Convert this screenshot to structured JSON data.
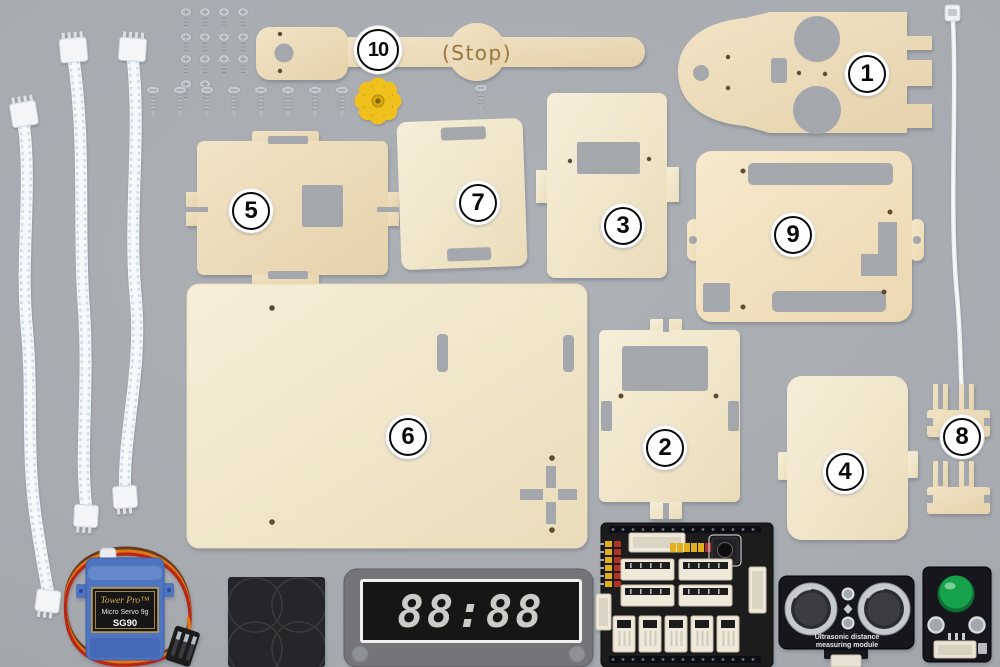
{
  "scene": {
    "width": 1000,
    "height": 667,
    "background": "#a7abb0",
    "description": "robot kit parts flat lay"
  },
  "badges": [
    {
      "num": "1",
      "x": 867,
      "y": 74
    },
    {
      "num": "2",
      "x": 665,
      "y": 448
    },
    {
      "num": "3",
      "x": 623,
      "y": 226
    },
    {
      "num": "4",
      "x": 845,
      "y": 472
    },
    {
      "num": "5",
      "x": 251,
      "y": 211
    },
    {
      "num": "6",
      "x": 408,
      "y": 437
    },
    {
      "num": "7",
      "x": 478,
      "y": 203
    },
    {
      "num": "8",
      "x": 962,
      "y": 437
    },
    {
      "num": "9",
      "x": 793,
      "y": 235
    },
    {
      "num": "10",
      "x": 378,
      "y": 50
    }
  ],
  "texts": {
    "stop_engraving": "(Stop)",
    "servo_brand": "Tower Pro™",
    "servo_model_line": "Micro Servo 9g",
    "servo_model": "SG90",
    "display_value": "88:88",
    "ultrasonic_line1": "Ultrasonic distance",
    "ultrasonic_line2": "measuring module"
  },
  "hardware": {
    "short_screw_rows": [
      4,
      4,
      4,
      2
    ],
    "long_screw_count": 8,
    "single_screw_count": 1,
    "cable_count": 3,
    "zip_tie_count": 1,
    "small_bracket_count": 2
  },
  "colors": {
    "wood": "#eddcb8",
    "wood_light": "#f3ead2",
    "hole": "#a4a8ad",
    "servo_blue": "#4f74c0",
    "horn_yellow": "#f0c01e",
    "pcb_black": "#1a1a1d",
    "led_green": "#19a24c",
    "screw_silver": "#c6cbd0",
    "connector_cream": "#efe9da"
  }
}
